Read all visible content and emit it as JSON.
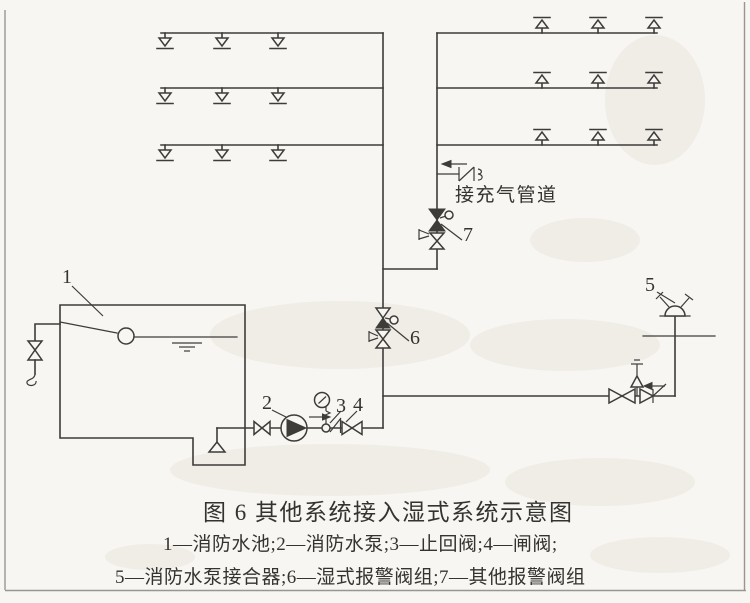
{
  "page": {
    "background": "#f8f6f2",
    "line_color": "#3d3c39",
    "border_color": "#9a968f"
  },
  "figure_caption": {
    "title": "图 6  其他系统接入湿式系统示意图",
    "legend_line1": "1—消防水池;2—消防水泵;3—止回阀;4—闸阀;",
    "legend_line2": "5—消防水泵接合器;6—湿式报警阀组;7—其他报警阀组"
  },
  "legend_items": [
    {
      "num": "1",
      "name": "消防水池"
    },
    {
      "num": "2",
      "name": "消防水泵"
    },
    {
      "num": "3",
      "name": "止回阀"
    },
    {
      "num": "4",
      "name": "闸阀"
    },
    {
      "num": "5",
      "name": "消防水泵接合器"
    },
    {
      "num": "6",
      "name": "湿式报警阀组"
    },
    {
      "num": "7",
      "name": "其他报警阀组"
    }
  ],
  "diagram": {
    "air_pipe_label": "接充气管道",
    "callouts": {
      "tank": "1",
      "pump": "2",
      "check_valve": "3",
      "gate_valve": "4",
      "siamese_connection": "5",
      "wet_alarm_valve": "6",
      "other_alarm_valve": "7"
    }
  }
}
